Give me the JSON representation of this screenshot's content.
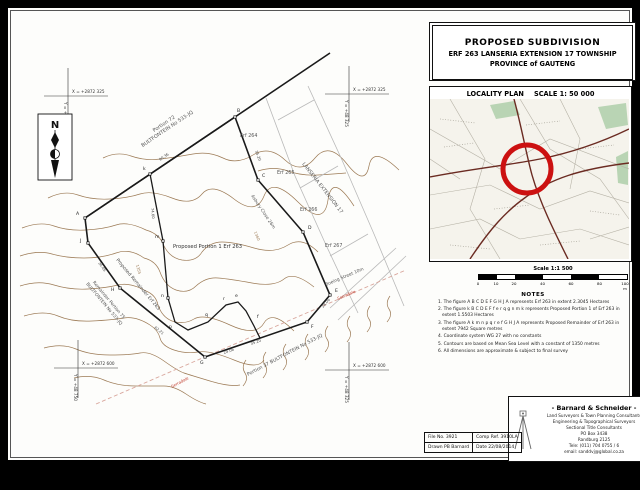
{
  "title_block": {
    "line1": "PROPOSED SUBDIVISION",
    "line2": "ERF 263 LANSERIA EXTENSION 17 TOWNSHIP",
    "line3": "PROVINCE of GAUTENG"
  },
  "locality": {
    "heading": "LOCALITY PLAN",
    "scale": "SCALE 1: 50 000"
  },
  "scale_bar": {
    "label": "Scale 1:1 500",
    "ticks": [
      "0",
      "10",
      "20",
      "40",
      "60",
      "80",
      "100 m"
    ]
  },
  "notes": {
    "heading": "NOTES",
    "items": [
      "1. The figure A B C D E F G H J A represents Erf 263 in extent 2.3045 Hectares",
      "2. The figure k B C D E F f e r q g n m k represents Proposed Portion 1 of Erf 263 in extent 1.5503 Hectares",
      "3. The figure A k m n p q r e f G H J A represents Proposed Remainder of Erf 263 in extent 7942 Square metres",
      "4. Coordinate system WG 27 with no constants",
      "5. Contours are based on Mean Sea Level with a constant of 1350 metres",
      "6. All dimensions are approximate & subject to final survey"
    ]
  },
  "company": {
    "name": "- Barnard & Schneider -",
    "lines": [
      "Land Surveyors & Town Planning Consultants",
      "Engineering & Topographical Surveyors",
      "Sectional Title Consultants",
      "PO Box 3438",
      "Randburg 2125",
      "Tele: (011) 704 0755 / 6",
      "email: sanddvj@global.co.za"
    ]
  },
  "file_table": {
    "file_no": "File No. 3921",
    "comp_ref": "Comp Ref. 3910LA",
    "drawn": "Drawn PB Barnard",
    "date": "Date 22/08/2014"
  },
  "plan": {
    "north_label": "N",
    "coord_crosses": {
      "tl": {
        "x": "X = +2872 325",
        "y": "Y = +48 750"
      },
      "tr": {
        "x": "X = +2872 325",
        "y": "Y = +48 325"
      },
      "bl": {
        "x": "X = +2872 600",
        "y": "Y = +48 750"
      },
      "br": {
        "x": "X = +2872 600",
        "y": "Y = +48 325"
      }
    },
    "labels": {
      "portion72_l1": "Portion 72",
      "portion72_l2": "BULTFONTEIN No 533-JQ",
      "erf264": "Erf 264",
      "erf265": "Erf 265",
      "erf266": "Erf 266",
      "erf267": "Erf 267",
      "township": "LANSERIA EXTENSION 17",
      "asbury": "Asbury Close 26m",
      "proposed_portion": "Proposed Portion 1 Erf 263",
      "proposed_remainder": "Proposed Remainder Erf 263",
      "remainder75_l1": "Remainder Portion 75",
      "remainder75_l2": "BULTFONTEIN No 533-JQ",
      "portion37": "Portion 37 BULTFONTEIN No 533-JQ",
      "boeing": "Boeing Street 10m",
      "serradale": "Serradale"
    },
    "vertices": [
      "A",
      "B",
      "C",
      "D",
      "E",
      "F",
      "G",
      "H",
      "J",
      "k",
      "m",
      "n",
      "p",
      "q",
      "r",
      "e",
      "f"
    ],
    "dimensions": [
      "90.36",
      "74.60",
      "35.20",
      "24.06",
      "35.20",
      "28.06",
      "36.05",
      "62.21"
    ],
    "contour_values": [
      "1360",
      "1355"
    ]
  },
  "colors": {
    "contour": "#9c7a55",
    "boundary": "#1a1a1a",
    "neighbor_line": "#b9b9b9",
    "marker_red": "#cc1111",
    "serradale_red": "#c03a2b",
    "road_dark": "#6b2b22"
  }
}
